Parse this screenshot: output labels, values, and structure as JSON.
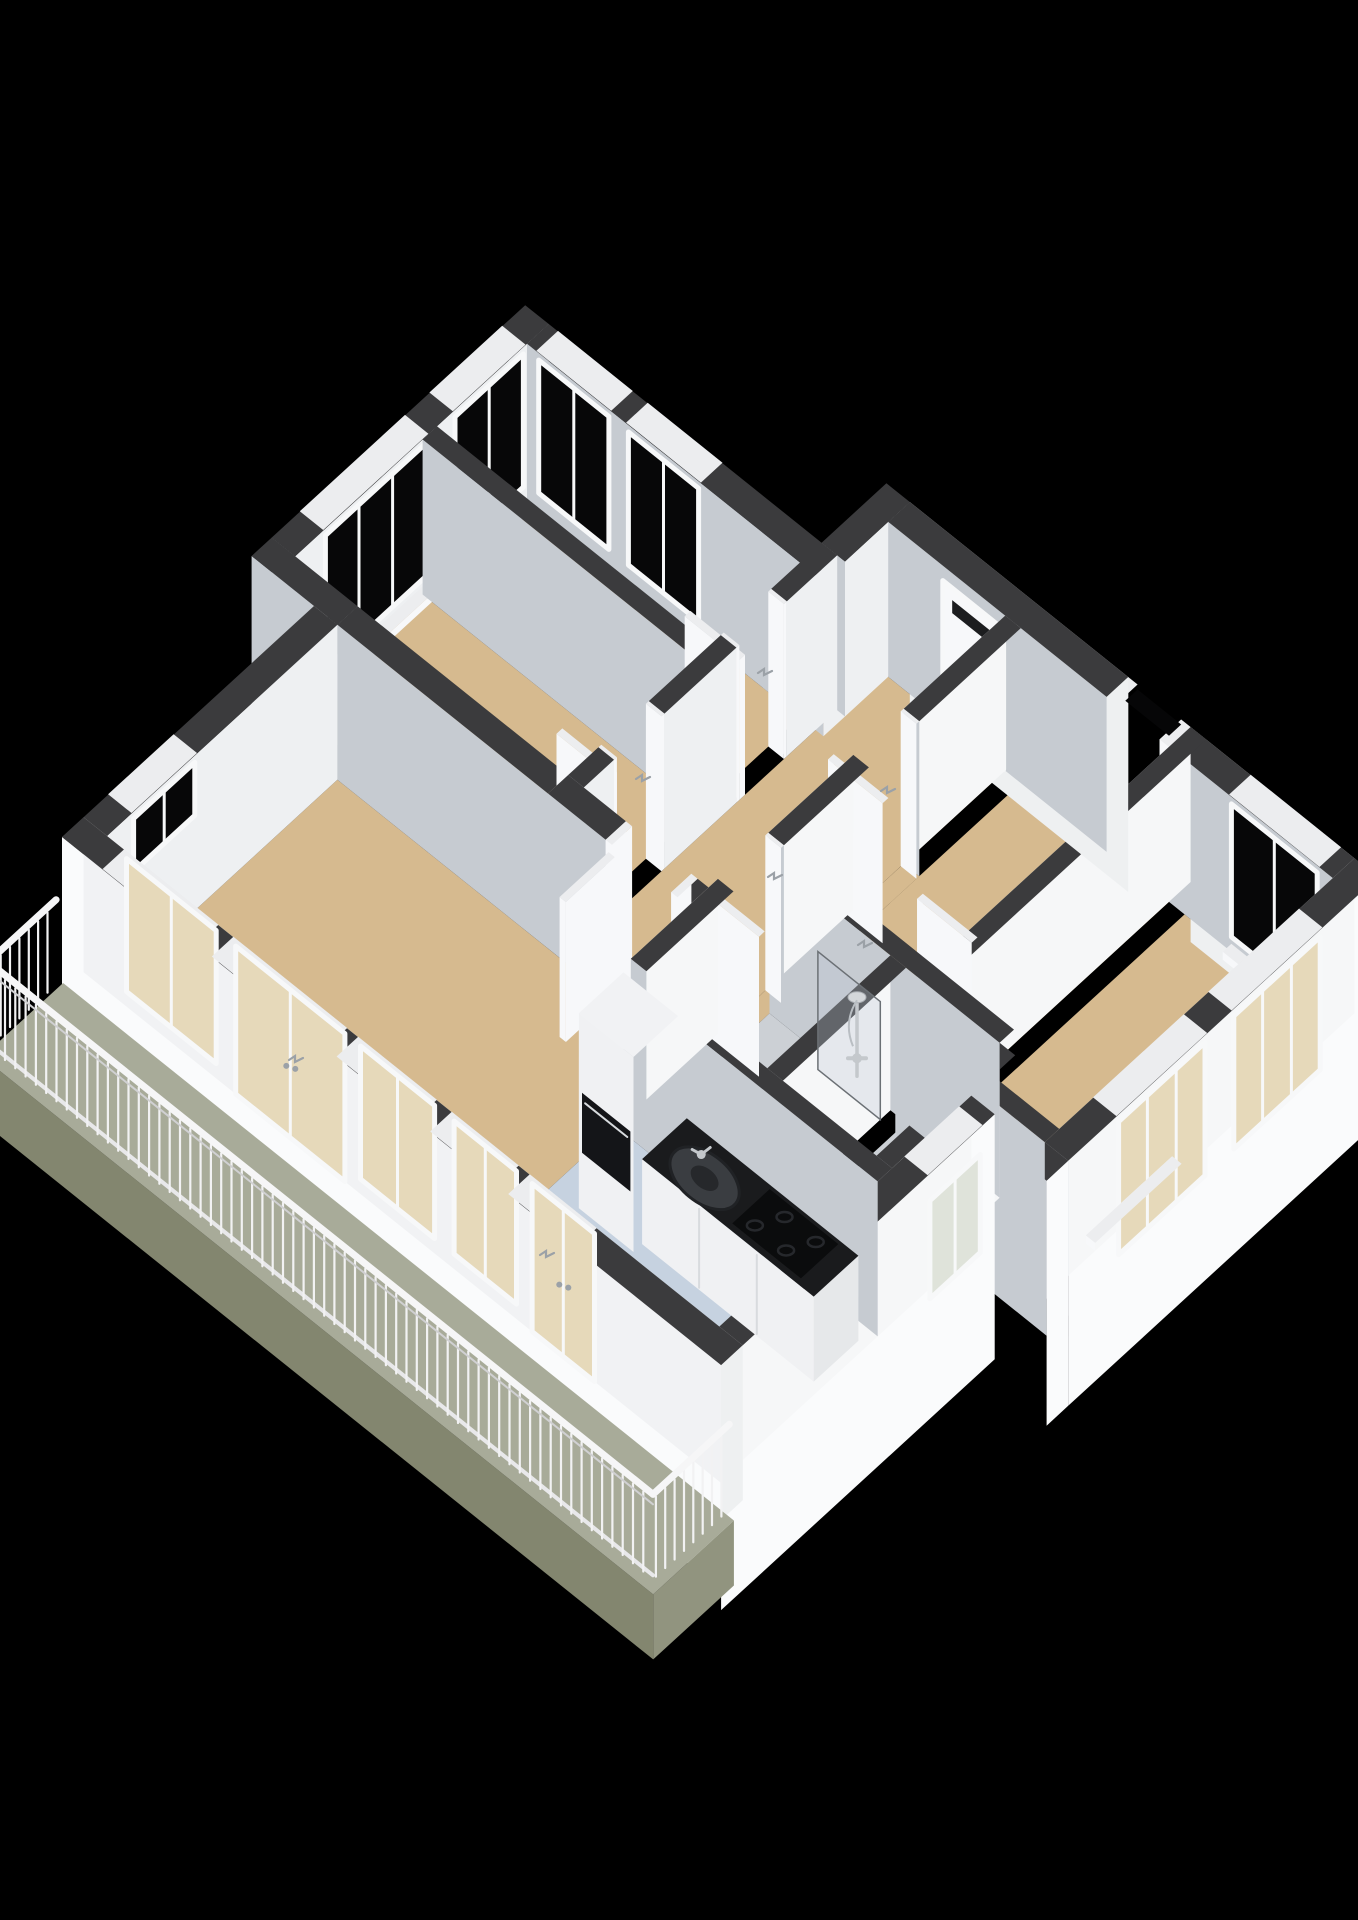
{
  "scene": {
    "type": "3d-floorplan-render",
    "background": "#000000",
    "canvas": {
      "width": 1358,
      "height": 1920
    },
    "rooms": [
      {
        "name": "living-room",
        "floor": "wood"
      },
      {
        "name": "kitchen",
        "floor": "blue-gray"
      },
      {
        "name": "hallway",
        "floor": "wood"
      },
      {
        "name": "bathroom",
        "floor": "gray",
        "fixtures": [
          "shower",
          "glass-panel"
        ]
      },
      {
        "name": "toilet",
        "floor": "gray"
      },
      {
        "name": "bedroom-left",
        "floor": "wood"
      },
      {
        "name": "bedroom-top",
        "floor": "wood"
      },
      {
        "name": "bedroom-right",
        "floor": "wood"
      },
      {
        "name": "bedroom-bottom-right",
        "floor": "wood"
      },
      {
        "name": "balcony",
        "floor": "gray-green",
        "fixtures": [
          "railing"
        ]
      }
    ],
    "fixtures_visible": [
      "kitchen-counter",
      "sink",
      "faucet",
      "gas-hob",
      "tall-cabinet-fridge",
      "oven-front",
      "shower-set",
      "shower-glass",
      "entry-door-mail-slot",
      "interior-door-leaves",
      "door-handles",
      "balcony-railing",
      "wall-niche"
    ]
  },
  "colors": {
    "bg": "#000000",
    "wallTop": "#3b3b3d",
    "wallTopJamb": "#ecedef",
    "faceMU": "#c6cbd1",
    "facePU": "#f1f2f4",
    "faceMV": "#f6f7f8",
    "facePV": "#eef0f2",
    "faceJamb": "#f7f8fa",
    "outer": "#fafbfc",
    "outerSide": "#eef0f1",
    "floorWood": "#d6ba8f",
    "floorKitchen": "#c6d2e0",
    "floorBath": "#ccd0d5",
    "floorBalcony": "#a8ab99",
    "balconyFront": "#83866f",
    "balconyEnd": "#91947f",
    "glassDark": "#070708",
    "glassTan": "#e6d9ba",
    "glassPale": "#dfe3da",
    "frame": "#f7f8f9",
    "counterTop": "#1a1b1d",
    "cabinet": "#f0f1f3",
    "cabinetSeam": "#d8dbde",
    "hob": "#0b0c0d",
    "burner": "#26282c",
    "sinkOuter": "#3a3d41",
    "sinkInner": "#26282b",
    "chrome": "#c4c8cc",
    "handle": "#9ba1a7",
    "mailSlot": "#1c1d1f",
    "nicheCore": "#060607",
    "railing": "#f2f2f3"
  },
  "projection": {
    "origin": [
      62,
      992
    ],
    "du": [
      0.72,
      -0.66
    ],
    "dv": [
      0.78,
      0.625
    ],
    "wallH": 155,
    "camera": [
      120,
      420
    ]
  },
  "floors": [
    {
      "n": "living-room-floor",
      "u": [
        30,
        350
      ],
      "v": [
        30,
        480
      ],
      "c": "floorWood"
    },
    {
      "n": "living-doorway-floor",
      "u": [
        350,
        378
      ],
      "v": [
        374,
        466
      ],
      "c": "floorWood"
    },
    {
      "n": "kitchen-floor",
      "u": [
        30,
        250
      ],
      "v": [
        480,
        815
      ],
      "c": "floorKitchen"
    },
    {
      "n": "bedroom-left-floor",
      "u": [
        378,
        555
      ],
      "v": [
        -50,
        300
      ],
      "c": "floorWood"
    },
    {
      "n": "bedroom-top-floor",
      "u": [
        575,
        700
      ],
      "v": [
        -50,
        300
      ],
      "c": "floorWood"
    },
    {
      "n": "hallway-floor",
      "u": [
        378,
        790
      ],
      "v": [
        320,
        480
      ],
      "c": "floorWood"
    },
    {
      "n": "hall-door-floor-a",
      "u": [
        391,
        480
      ],
      "v": [
        480,
        500
      ],
      "c": "floorWood"
    },
    {
      "n": "hall-door-floor-b",
      "u": [
        579,
        649
      ],
      "v": [
        480,
        500
      ],
      "c": "floorWood"
    },
    {
      "n": "bathroom-floor",
      "u": [
        270,
        441
      ],
      "v": [
        500,
        655
      ],
      "c": "floorBath"
    },
    {
      "n": "toilet-floor",
      "u": [
        270,
        441
      ],
      "v": [
        675,
        795
      ],
      "c": "floorBath"
    },
    {
      "n": "bedroom-right-floor",
      "u": [
        461,
        790
      ],
      "v": [
        500,
        690
      ],
      "c": "floorWood"
    },
    {
      "n": "bedroom-bottom-right-floor",
      "u": [
        410,
        790
      ],
      "v": [
        710,
        900
      ],
      "c": "floorWood"
    }
  ],
  "walls": [
    {
      "n": "nw-wall-living",
      "u": [
        0,
        350
      ],
      "v": [
        0,
        30
      ],
      "dec": [
        {
          "t": "win",
          "dir": "u",
          "at": 30,
          "r": [
            67,
            152
          ],
          "z": [
            95,
            148
          ],
          "g": "glassDark",
          "m": 1,
          "top": 1
        }
      ]
    },
    {
      "n": "nw-step-wall",
      "u": [
        350,
        378
      ],
      "v": [
        -80,
        30
      ]
    },
    {
      "n": "nw-wall-bedrooms",
      "u": [
        378,
        730
      ],
      "v": [
        -80,
        -50
      ],
      "dec": [
        {
          "t": "win",
          "dir": "u",
          "at": -50,
          "r": [
            420,
            560
          ],
          "z": [
            15,
            148
          ],
          "g": "glassDark",
          "m": 2,
          "top": 1
        },
        {
          "t": "win",
          "dir": "u",
          "at": -50,
          "r": [
            600,
            695
          ],
          "z": [
            15,
            148
          ],
          "g": "glassDark",
          "m": 1,
          "top": 1
        }
      ]
    },
    {
      "n": "sw-wall-balcony-side",
      "u": [
        0,
        30
      ],
      "v": [
        0,
        845
      ],
      "outer": [
        "mu"
      ],
      "cap": [
        "v2"
      ],
      "dec": [
        {
          "t": "win",
          "dir": "v",
          "at": 30,
          "r": [
            55,
            170
          ],
          "z": [
            15,
            148
          ],
          "g": "glassTan",
          "m": 1,
          "top": 1
        },
        {
          "t": "win",
          "dir": "v",
          "at": 30,
          "r": [
            195,
            335
          ],
          "z": [
            0,
            148
          ],
          "g": "glassTan",
          "m": 1,
          "top": 1,
          "door": 1
        },
        {
          "t": "win",
          "dir": "v",
          "at": 30,
          "r": [
            355,
            450
          ],
          "z": [
            15,
            148
          ],
          "g": "glassTan",
          "m": 1,
          "top": 1
        },
        {
          "t": "win",
          "dir": "v",
          "at": 30,
          "r": [
            475,
            555
          ],
          "z": [
            15,
            148
          ],
          "g": "glassTan",
          "m": 1,
          "top": 1
        },
        {
          "t": "win",
          "dir": "v",
          "at": 30,
          "r": [
            575,
            655
          ],
          "z": [
            0,
            148
          ],
          "g": "glassTan",
          "m": 1,
          "top": 1,
          "door": 1
        }
      ]
    },
    {
      "n": "ne-wall-bedroom-top",
      "u": [
        700,
        730
      ],
      "v": [
        -50,
        330
      ],
      "dec": [
        {
          "t": "win",
          "dir": "v",
          "at": 700,
          "r": [
            -35,
            55
          ],
          "z": [
            15,
            148
          ],
          "g": "glassDark",
          "m": 1,
          "top": 1
        },
        {
          "t": "win",
          "dir": "v",
          "at": 700,
          "r": [
            80,
            170
          ],
          "z": [
            15,
            148
          ],
          "g": "glassDark",
          "m": 1,
          "top": 1
        }
      ]
    },
    {
      "n": "entry-jut-wall",
      "u": [
        730,
        820
      ],
      "v": [
        300,
        330
      ]
    },
    {
      "n": "ne-wall-entry",
      "u": [
        790,
        820
      ],
      "v": [
        330,
        610
      ],
      "outer": [
        "pu"
      ],
      "dec": [
        {
          "t": "win",
          "dir": "v",
          "at": 790,
          "r": [
            400,
            478
          ],
          "z": [
            0,
            140
          ],
          "g": "faceJamb",
          "door": 1,
          "mail": 1
        }
      ]
    },
    {
      "n": "niche-lip-a",
      "u": [
        790,
        820
      ],
      "v": [
        610,
        622
      ],
      "jamb": 1
    },
    {
      "n": "niche-lip-b",
      "u": [
        790,
        820
      ],
      "v": [
        678,
        690
      ],
      "jamb": 1
    },
    {
      "n": "ne-wall-bedroom-right",
      "u": [
        790,
        820
      ],
      "v": [
        690,
        930
      ],
      "outer": [
        "pu"
      ],
      "dec": [
        {
          "t": "win",
          "dir": "v",
          "at": 790,
          "r": [
            770,
            880
          ],
          "z": [
            15,
            148
          ],
          "g": "glassDark",
          "m": 1,
          "top": 1
        }
      ]
    },
    {
      "n": "se-wall-bedroom-bottom",
      "u": [
        390,
        820
      ],
      "v": [
        900,
        930
      ],
      "outer": [
        "pv"
      ],
      "dec": [
        {
          "t": "win",
          "dir": "u",
          "at": 930,
          "r": [
            460,
            580
          ],
          "z": [
            15,
            148
          ],
          "g": "glassTan",
          "m": 2,
          "top": 1
        },
        {
          "t": "win",
          "dir": "u",
          "at": 930,
          "r": [
            620,
            740
          ],
          "z": [
            15,
            148
          ],
          "g": "glassTan",
          "m": 2,
          "top": 1
        }
      ]
    },
    {
      "n": "se-step-wall",
      "u": [
        360,
        390
      ],
      "v": [
        815,
        930
      ],
      "outer": [
        "pv"
      ]
    },
    {
      "n": "se-wall-kitchen",
      "u": [
        0,
        380
      ],
      "v": [
        815,
        845
      ],
      "outer": [
        "pv"
      ],
      "dec": [
        {
          "t": "win",
          "dir": "u",
          "at": 845,
          "r": [
            290,
            360
          ],
          "z": [
            30,
            128
          ],
          "g": "glassPale",
          "m": 1,
          "top": 1
        }
      ]
    },
    {
      "n": "partition-living-bedroom",
      "u": [
        350,
        378
      ],
      "v": [
        30,
        300
      ]
    },
    {
      "n": "partition-living-hall-a",
      "u": [
        350,
        378
      ],
      "v": [
        300,
        374
      ]
    },
    {
      "n": "living-door-jamb-a",
      "u": [
        350,
        378
      ],
      "v": [
        374,
        382
      ],
      "jamb": 1
    },
    {
      "n": "living-door-jamb-b",
      "u": [
        350,
        378
      ],
      "v": [
        458,
        466
      ],
      "jamb": 1
    },
    {
      "n": "partition-living-hall-b",
      "u": [
        350,
        378
      ],
      "v": [
        466,
        480
      ]
    },
    {
      "n": "partition-kitchen-core",
      "u": [
        250,
        270
      ],
      "v": [
        480,
        815
      ]
    },
    {
      "n": "partition-toilet-south",
      "u": [
        270,
        441
      ],
      "v": [
        795,
        815
      ]
    },
    {
      "n": "partition-bath-toilet",
      "u": [
        270,
        441
      ],
      "v": [
        655,
        675
      ]
    },
    {
      "n": "partition-core-east",
      "u": [
        441,
        461
      ],
      "v": [
        500,
        795
      ]
    },
    {
      "n": "partition-bedrooms-top",
      "u": [
        555,
        575
      ],
      "v": [
        -50,
        300
      ]
    },
    {
      "n": "hall-nw-wall-a",
      "u": [
        378,
        420
      ],
      "v": [
        300,
        320
      ]
    },
    {
      "n": "hall-jamb-1",
      "u": [
        420,
        424
      ],
      "v": [
        300,
        320
      ],
      "jamb": 1
    },
    {
      "n": "hall-jamb-2",
      "u": [
        486,
        490
      ],
      "v": [
        300,
        320
      ],
      "jamb": 1
    },
    {
      "n": "hall-nw-wall-b",
      "u": [
        490,
        590
      ],
      "v": [
        300,
        320
      ]
    },
    {
      "n": "hall-jamb-3",
      "u": [
        590,
        594
      ],
      "v": [
        300,
        320
      ],
      "jamb": 1
    },
    {
      "n": "hall-jamb-4",
      "u": [
        656,
        660
      ],
      "v": [
        300,
        320
      ],
      "jamb": 1
    },
    {
      "n": "hall-nw-wall-c",
      "u": [
        660,
        730
      ],
      "v": [
        300,
        320
      ]
    },
    {
      "n": "hall-se-wall-a",
      "u": [
        270,
        391
      ],
      "v": [
        480,
        500
      ]
    },
    {
      "n": "hall-jamb-5",
      "u": [
        457,
        461
      ],
      "v": [
        480,
        500
      ],
      "jamb": 1
    },
    {
      "n": "hall-se-wall-b",
      "u": [
        461,
        579
      ],
      "v": [
        480,
        500
      ]
    },
    {
      "n": "hall-jamb-6",
      "u": [
        645,
        649
      ],
      "v": [
        480,
        500
      ],
      "jamb": 1
    },
    {
      "n": "hall-se-wall-c",
      "u": [
        649,
        790
      ],
      "v": [
        480,
        500
      ]
    },
    {
      "n": "partition-bedrooms-right",
      "u": [
        410,
        820
      ],
      "v": [
        690,
        710
      ]
    },
    {
      "n": "partition-bedroom-west",
      "u": [
        390,
        410
      ],
      "v": [
        710,
        900
      ]
    },
    {
      "n": "door-leaf-bedroom-right",
      "u": [
        571,
        579
      ],
      "v": [
        455,
        525
      ],
      "jamb": 1,
      "h": 140
    },
    {
      "n": "door-leaf-bath",
      "u": [
        383,
        391
      ],
      "v": [
        470,
        540
      ],
      "jamb": 1,
      "h": 140
    },
    {
      "n": "door-leaf-living",
      "u": [
        286,
        354
      ],
      "v": [
        374,
        382
      ],
      "jamb": 1,
      "h": 140
    },
    {
      "n": "door-leaf-inside-bedroom",
      "u": [
        516,
        524
      ],
      "v": [
        620,
        690
      ],
      "jamb": 1,
      "h": 140
    },
    {
      "n": "door-leaf-bedroom-left",
      "u": [
        416,
        424
      ],
      "v": [
        250,
        320
      ],
      "jamb": 1,
      "h": 140
    },
    {
      "n": "door-leaf-bedroom-top",
      "u": [
        594,
        602
      ],
      "v": [
        250,
        320
      ],
      "jamb": 1,
      "h": 140
    },
    {
      "n": "sill-bedroom-left",
      "u": [
        420,
        560
      ],
      "v": [
        -50,
        -38
      ],
      "jamb": 1,
      "h": 8
    },
    {
      "n": "sill-bedroom-top",
      "u": [
        600,
        695
      ],
      "v": [
        -50,
        -38
      ],
      "jamb": 1,
      "h": 8
    },
    {
      "n": "sill-bedroom-top-ne-a",
      "u": [
        700,
        712
      ],
      "v": [
        -35,
        55
      ],
      "jamb": 1,
      "h": 8
    },
    {
      "n": "sill-bedroom-top-ne-b",
      "u": [
        700,
        712
      ],
      "v": [
        80,
        170
      ],
      "jamb": 1,
      "h": 8
    },
    {
      "n": "sill-bedroom-right",
      "u": [
        778,
        790
      ],
      "v": [
        770,
        880
      ],
      "jamb": 1,
      "h": 8
    },
    {
      "n": "sill-bedroom-bottom-a",
      "u": [
        460,
        580
      ],
      "v": [
        888,
        900
      ],
      "jamb": 1,
      "h": 8
    },
    {
      "n": "sill-bedroom-bottom-b",
      "u": [
        620,
        740
      ],
      "v": [
        888,
        900
      ],
      "jamb": 1,
      "h": 8
    }
  ],
  "flats": [
    {
      "n": "niche-opening",
      "u": [
        803,
        820
      ],
      "v": [
        622,
        678
      ],
      "z": 150,
      "c": "nicheCore"
    }
  ],
  "kitchen": {
    "fridge": {
      "u": [
        160,
        222
      ],
      "v": [
        515,
        585
      ],
      "h": 195,
      "oven_z": [
        58,
        118
      ],
      "oven_v": [
        519,
        581
      ]
    },
    "counter": {
      "u": [
        172,
        234
      ],
      "v": [
        585,
        805
      ],
      "h": 85,
      "seams": [
        658,
        732
      ]
    },
    "sink": {
      "u": 197,
      "v": 642,
      "rx": 40,
      "ry": 24
    },
    "faucet": {
      "u": 214,
      "v": 622
    },
    "hob": {
      "u": [
        178,
        230
      ],
      "v": [
        695,
        783
      ],
      "burners": [
        [
          191,
          712
        ],
        [
          217,
          726
        ],
        [
          191,
          752
        ],
        [
          217,
          766
        ]
      ]
    }
  },
  "shower": {
    "pole": [
      400,
      650
    ],
    "pole_z": [
      58,
      134
    ],
    "head_r": 8,
    "mixer_z": 76,
    "glass": {
      "u": 427,
      "v": [
        575,
        655
      ],
      "z": 118
    }
  },
  "balcony": {
    "slab_u": [
      -104,
      8
    ],
    "slab_v": [
      -6,
      854
    ],
    "rail_u": -100,
    "rail_h": 95,
    "post_step": 13.2,
    "post_z": [
      10,
      90
    ],
    "return_v": 850,
    "north_return_u": [
      -96,
      -12
    ]
  },
  "handles_screen": [
    [
      636,
      779
    ],
    [
      758,
      673
    ],
    [
      881,
      791
    ],
    [
      768,
      877
    ],
    [
      858,
      945
    ],
    [
      540,
      1255
    ],
    [
      289,
      1060
    ]
  ]
}
